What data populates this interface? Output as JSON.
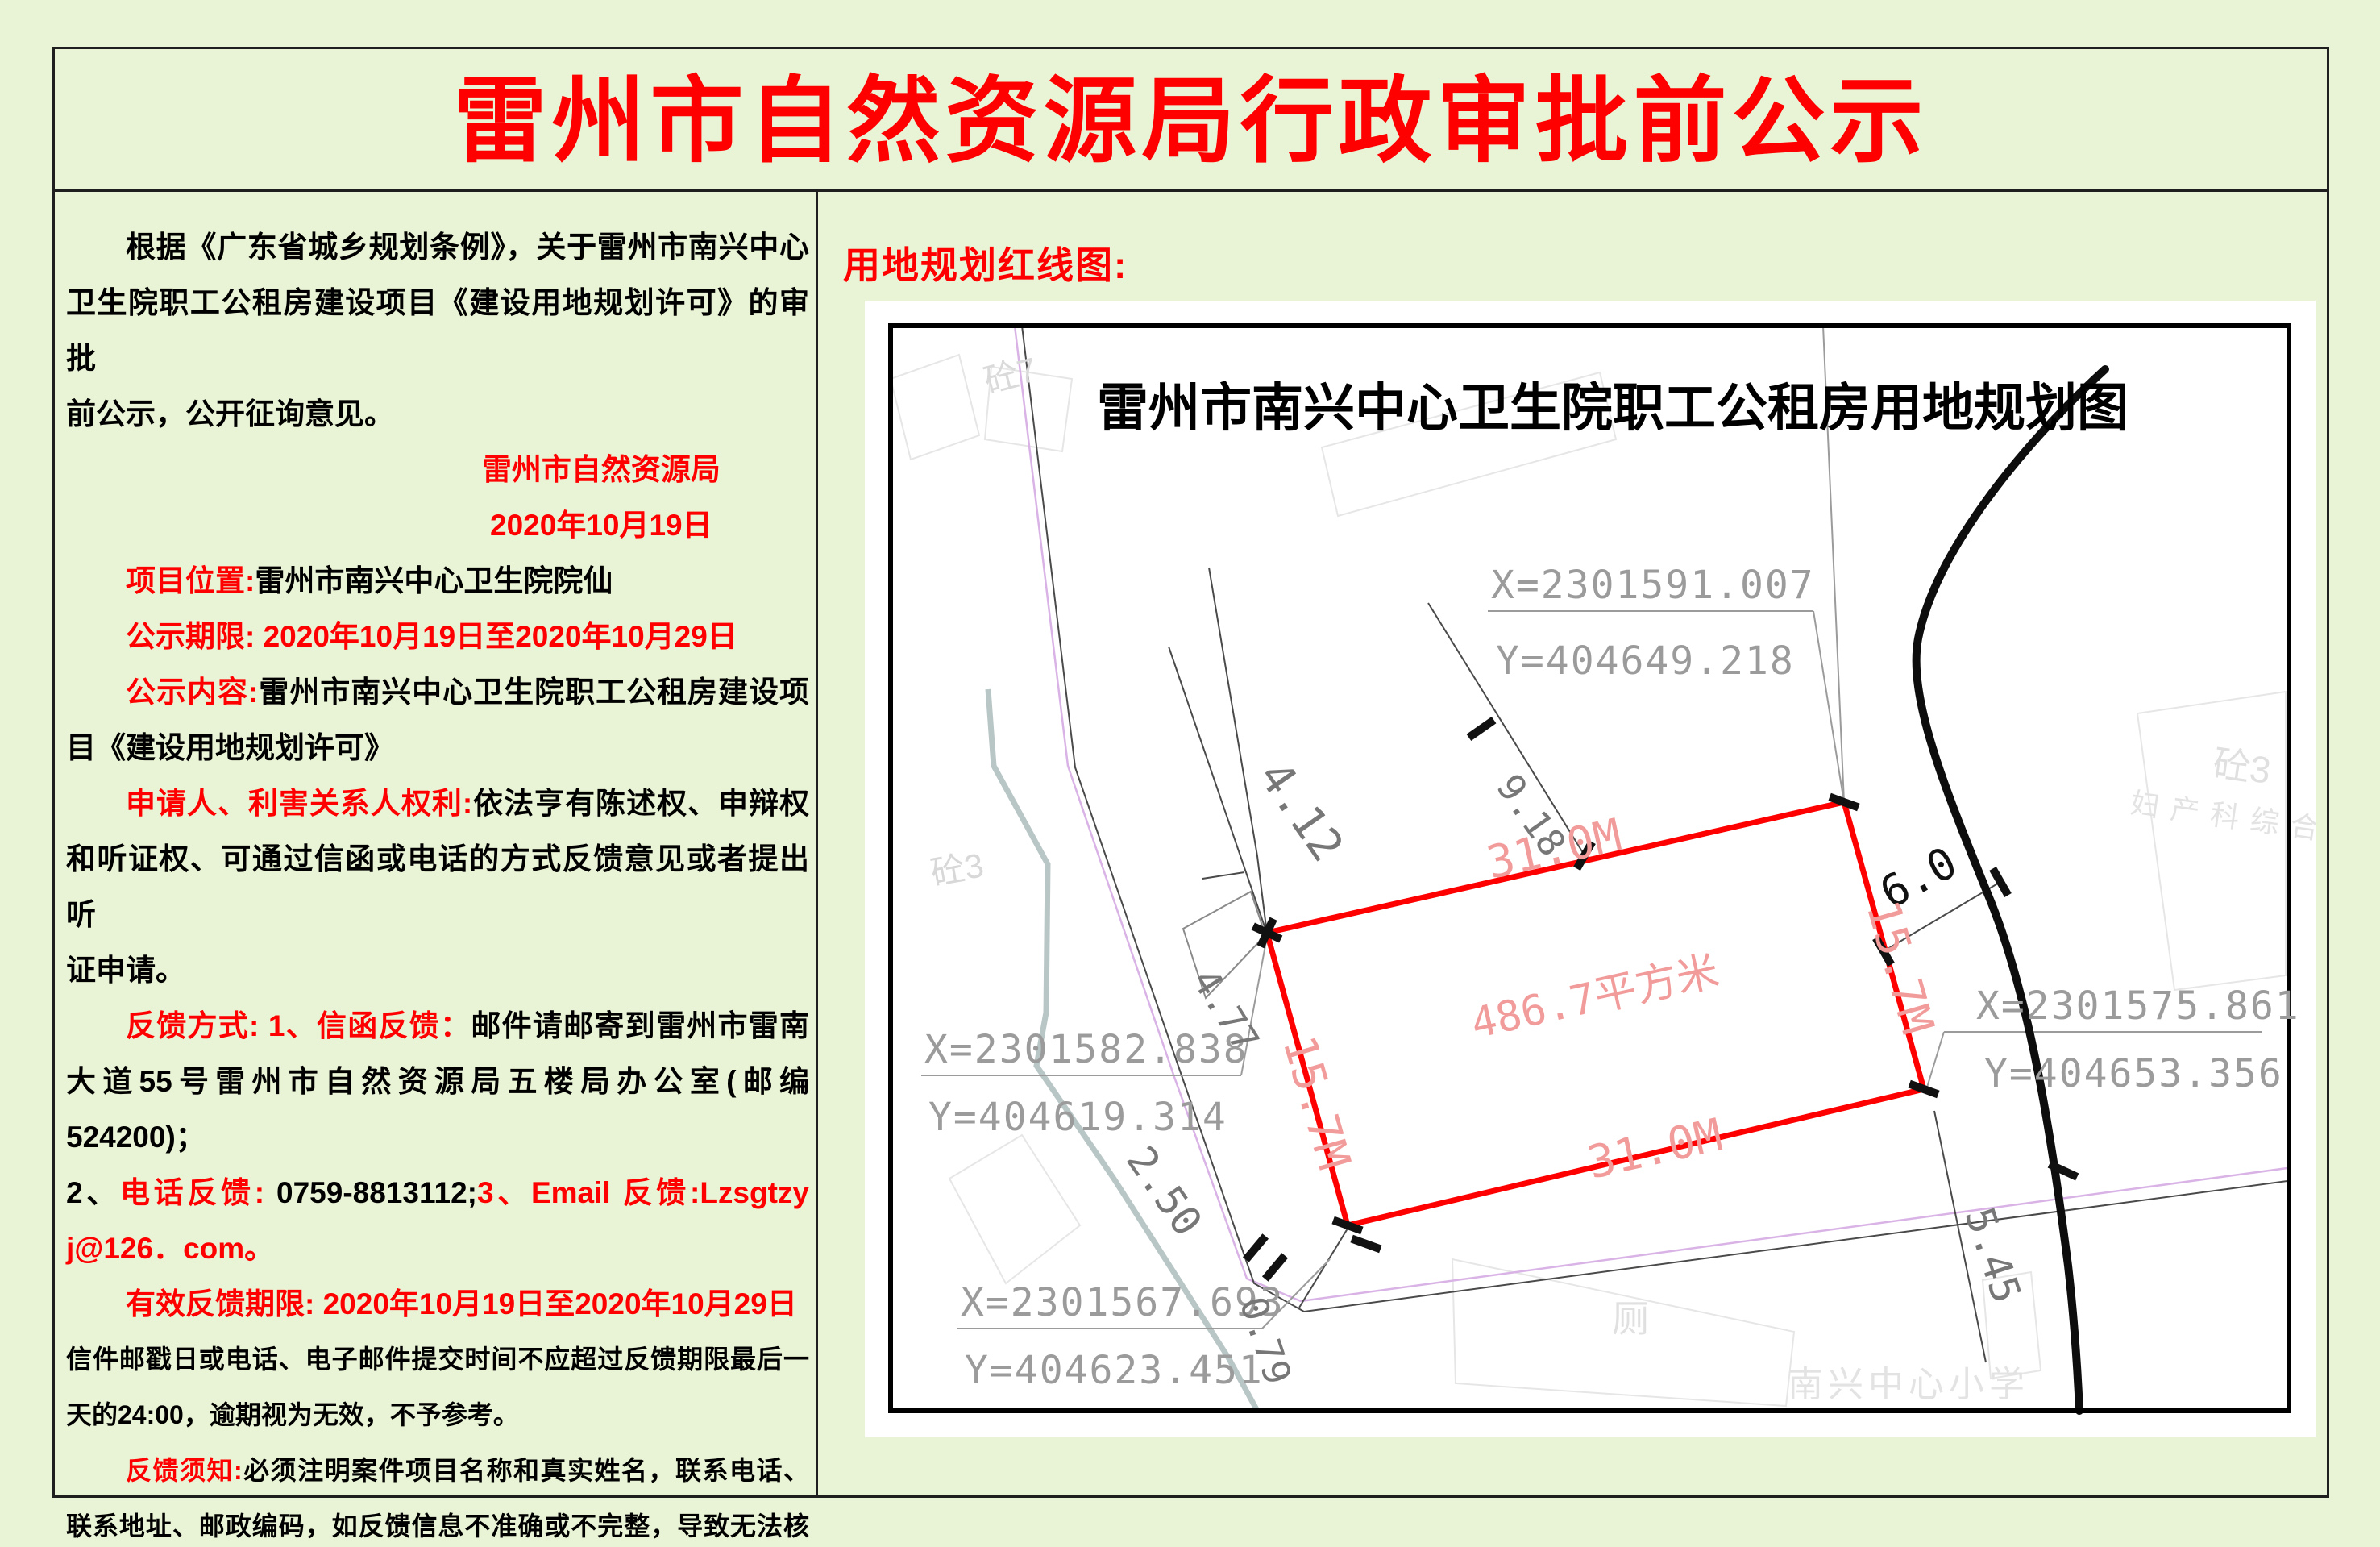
{
  "page": {
    "title": "雷州市自然资源局行政审批前公示",
    "accent_color": "#fe0000",
    "background_color": "#e9f3d5"
  },
  "notice": {
    "lines": [
      {
        "cls": "ind jl",
        "seg": [
          {
            "t": "根据《广东省城乡规划条例》，关于雷州市南兴中心",
            "c": "k"
          }
        ]
      },
      {
        "cls": "jl",
        "seg": [
          {
            "t": "卫生院职工公租房建设项目《建设用地规划许可》的审批",
            "c": "k"
          }
        ]
      },
      {
        "cls": "",
        "seg": [
          {
            "t": "前公示，公开征询意见。",
            "c": "k"
          }
        ]
      },
      {
        "cls": "org",
        "seg": [
          {
            "t": "雷州市自然资源局",
            "c": "r"
          }
        ]
      },
      {
        "cls": "org",
        "seg": [
          {
            "t": "2020年10月19日",
            "c": "r"
          }
        ]
      },
      {
        "cls": "ind",
        "seg": [
          {
            "t": "项目位置:",
            "c": "r"
          },
          {
            "t": "雷州市南兴中心卫生院院仙",
            "c": "k"
          }
        ]
      },
      {
        "cls": "ind",
        "seg": [
          {
            "t": "公示期限: 2020年10月19日至2020年10月29日",
            "c": "r"
          }
        ]
      },
      {
        "cls": "ind jl",
        "seg": [
          {
            "t": "公示内容:",
            "c": "r"
          },
          {
            "t": "雷州市南兴中心卫生院职工公租房建设项",
            "c": "k"
          }
        ]
      },
      {
        "cls": "",
        "seg": [
          {
            "t": "目《建设用地规划许可》",
            "c": "k"
          }
        ]
      },
      {
        "cls": "ind jl",
        "seg": [
          {
            "t": "申请人、利害关系人权利:",
            "c": "r"
          },
          {
            "t": "依法亨有陈述权、申辩权",
            "c": "k"
          }
        ]
      },
      {
        "cls": "jl",
        "seg": [
          {
            "t": "和听证权、可通过信函或电话的方式反馈意见或者提出听",
            "c": "k"
          }
        ]
      },
      {
        "cls": "",
        "seg": [
          {
            "t": "证申请。",
            "c": "k"
          }
        ]
      },
      {
        "cls": "ind jl",
        "seg": [
          {
            "t": "反馈方式: 1、信函反馈：",
            "c": "r"
          },
          {
            "t": "邮件请邮寄到雷州市雷南",
            "c": "k"
          }
        ]
      },
      {
        "cls": "jl",
        "seg": [
          {
            "t": "大道55号雷州市自然资源局五楼局办公室(邮编524200)；",
            "c": "k"
          }
        ]
      },
      {
        "cls": "jl",
        "seg": [
          {
            "t": "2、",
            "c": "k"
          },
          {
            "t": "电话反馈: ",
            "c": "r"
          },
          {
            "t": "0759-8813112;",
            "c": "k"
          },
          {
            "t": "3、Email 反馈:Lzsgtzy",
            "c": "r"
          }
        ]
      },
      {
        "cls": "",
        "seg": [
          {
            "t": "j@126．com。",
            "c": "r"
          }
        ]
      },
      {
        "cls": "ind",
        "seg": [
          {
            "t": "有效反馈期限: 2020年10月19日至2020年10月29日",
            "c": "r"
          }
        ]
      },
      {
        "cls": "sm jl",
        "seg": [
          {
            "t": "信件邮戳日或电话、电子邮件提交时间不应超过反馈期限最后一",
            "c": "k"
          }
        ]
      },
      {
        "cls": "sm",
        "seg": [
          {
            "t": "天的24:00，逾期视为无效，不予参考。",
            "c": "k"
          }
        ]
      },
      {
        "cls": "ind sm jl",
        "seg": [
          {
            "t": "反馈须知:",
            "c": "r"
          },
          {
            "t": "必须注明案件项目名称和真实姓名，联系电话、",
            "c": "k"
          }
        ]
      },
      {
        "cls": "sm jl",
        "seg": [
          {
            "t": "联系地址、邮政编码，如反馈信息不准确或不完整，导致无法核",
            "c": "k"
          }
        ]
      },
      {
        "cls": "",
        "seg": [
          {
            "t": "实有关情况的视为无效。",
            "c": "k"
          }
        ]
      }
    ]
  },
  "map_panel": {
    "heading": "用地规划红线图:"
  },
  "map": {
    "title": "雷州市南兴中心卫生院职工公租房用地规划图",
    "corner_coords": [
      {
        "x": "X=2301591.007",
        "y": "Y=404649.218"
      },
      {
        "x": "X=2301582.838",
        "y": "Y=404619.314"
      },
      {
        "x": "X=2301567.693",
        "y": "Y=404623.451"
      },
      {
        "x": "X=2301575.861",
        "y": "Y=404653.356"
      }
    ],
    "parcel": {
      "area": "486.7平方米",
      "side_top": "31.0M",
      "side_bottom": "31.0M",
      "side_left": "15.7M",
      "side_right": "15.7M",
      "line_color": "#fe0000"
    },
    "dims": {
      "d918": "9.18",
      "d412": "4.12",
      "d477": "4.77",
      "d250": "2.50",
      "d079": "0.79",
      "d60": "6.0",
      "d545": "5.45"
    },
    "features": {
      "tong7": "砼7",
      "tong3_left": "砼3",
      "tong3_right": "砼3",
      "maternity_building": "妇产科综合楼",
      "toilet": "厕",
      "school": "南兴中心小学"
    }
  }
}
